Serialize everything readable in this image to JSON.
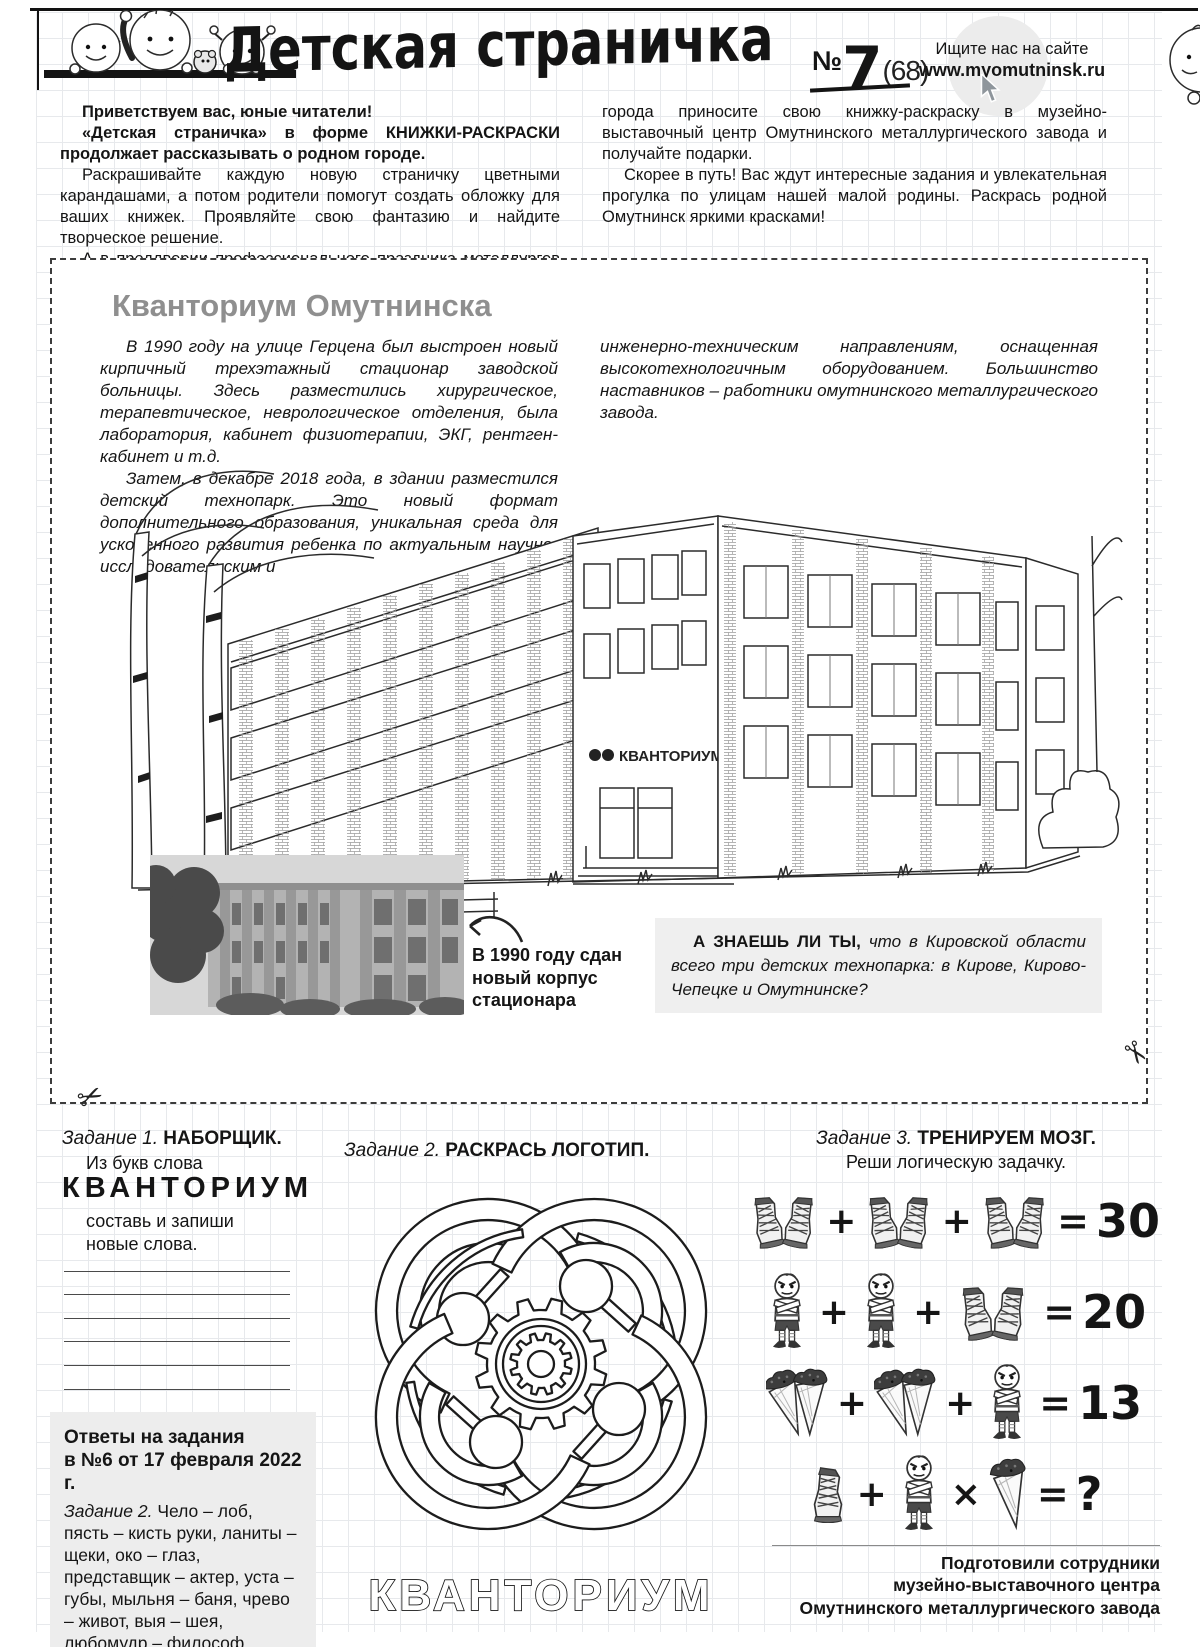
{
  "masthead": {
    "title": "Детская страничка",
    "issue_prefix": "№",
    "issue_number": "7",
    "issue_suffix": "(68)",
    "site_hint": "Ищите нас на сайте",
    "site_url": "www.myomutninsk.ru"
  },
  "intro": {
    "col1": [
      "Приветствуем вас, юные читатели!",
      "«Детская страничка» в форме КНИЖКИ-РАСКРАСКИ продолжает рассказывать о родном городе.",
      "Раскрашивайте каждую новую страничку цветными карандашами, а потом родители помогут создать обложку для ваших книжек. Проявляйте свою фантазию и найдите творческое решение.",
      "А в преддверии профессионального праздника металлургов и Дня"
    ],
    "col2": [
      "города приносите свою книжку-раскраску в музейно-выставочный центр Омутнинского металлургического завода и получайте подарки.",
      "Скорее в путь! Вас ждут интересные задания и увлекательная прогулка по улицам нашей малой родины. Раскрась родной Омутнинск яркими красками!"
    ]
  },
  "article": {
    "title": "Кванториум Омутнинска",
    "col1": [
      "В 1990 году на улице Герцена был выстроен новый кирпичный трехэтажный стационар заводской больницы. Здесь разместились хирургическое, терапевтическое, неврологическое отделения, была лаборатория, кабинет физиотерапии, ЭКГ, рентген-кабинет  и т.д.",
      "Затем, в декабре 2018 года, в здании разместился детский технопарк. Это новый формат дополнительного образования, уникальная среда для ускоренного развития ребенка по актуальным научно-исследовательским и"
    ],
    "col2": [
      "инженерно-техническим направлениям, оснащенная высокотехнологичным оборудованием. Большинство наставников – работники омутнинского металлургического завода."
    ],
    "building_sign": "КВАНТОРИУМ",
    "photo_caption": "В 1990 году сдан новый корпус стационара",
    "fact_lead": "А ЗНАЕШЬ ЛИ ТЫ,",
    "fact_text": "что в Кировской области всего три детских технопарка: в Кирове, Кирово-Чепецке и Омутнинске?"
  },
  "tasks": {
    "task1": {
      "label": "Задание 1.",
      "name": "НАБОРЩИК.",
      "intro1": "Из букв слова",
      "word": "КВАНТОРИУМ",
      "intro2": "составь и запиши новые слова."
    },
    "task2": {
      "label": "Задание 2.",
      "name": "РАСКРАСЬ ЛОГОТИП.",
      "logo_word": "КВАНТОРИУМ"
    },
    "task3": {
      "label": "Задание 3.",
      "name": "ТРЕНИРУЕМ МОЗГ.",
      "subtitle": "Реши логическую задачку.",
      "rows": [
        {
          "items": [
            "sneakers-pair",
            "sneakers-pair",
            "sneakers-pair"
          ],
          "ops": [
            "+",
            "+"
          ],
          "result": "30"
        },
        {
          "items": [
            "boy",
            "boy",
            "sneakers-pair"
          ],
          "ops": [
            "+",
            "+"
          ],
          "result": "20"
        },
        {
          "items": [
            "seed-cones",
            "seed-cones",
            "boy"
          ],
          "ops": [
            "+",
            "+"
          ],
          "result": "13"
        },
        {
          "items": [
            "sneaker",
            "boy",
            "seed-cone"
          ],
          "ops": [
            "+",
            "×"
          ],
          "result": "?"
        }
      ]
    }
  },
  "answers": {
    "title1": "Ответы на задания",
    "title2": "в №6 от 17 февраля 2022 г.",
    "label": "Задание 2.",
    "text": "Чело – лоб, пясть – кисть руки, ланиты – щеки, око – глаз, представщик – актер, уста – губы, мыльня – баня, чрево – живот, выя – шея, любомудр – философ."
  },
  "footer": {
    "line1": "Подготовили сотрудники",
    "line2": "музейно-выставочного центра",
    "line3": "Омутнинского металлургического завода"
  },
  "colors": {
    "article_title_gray": "#8f8f8f",
    "box_gray": "#efefef",
    "ink": "#151515"
  }
}
